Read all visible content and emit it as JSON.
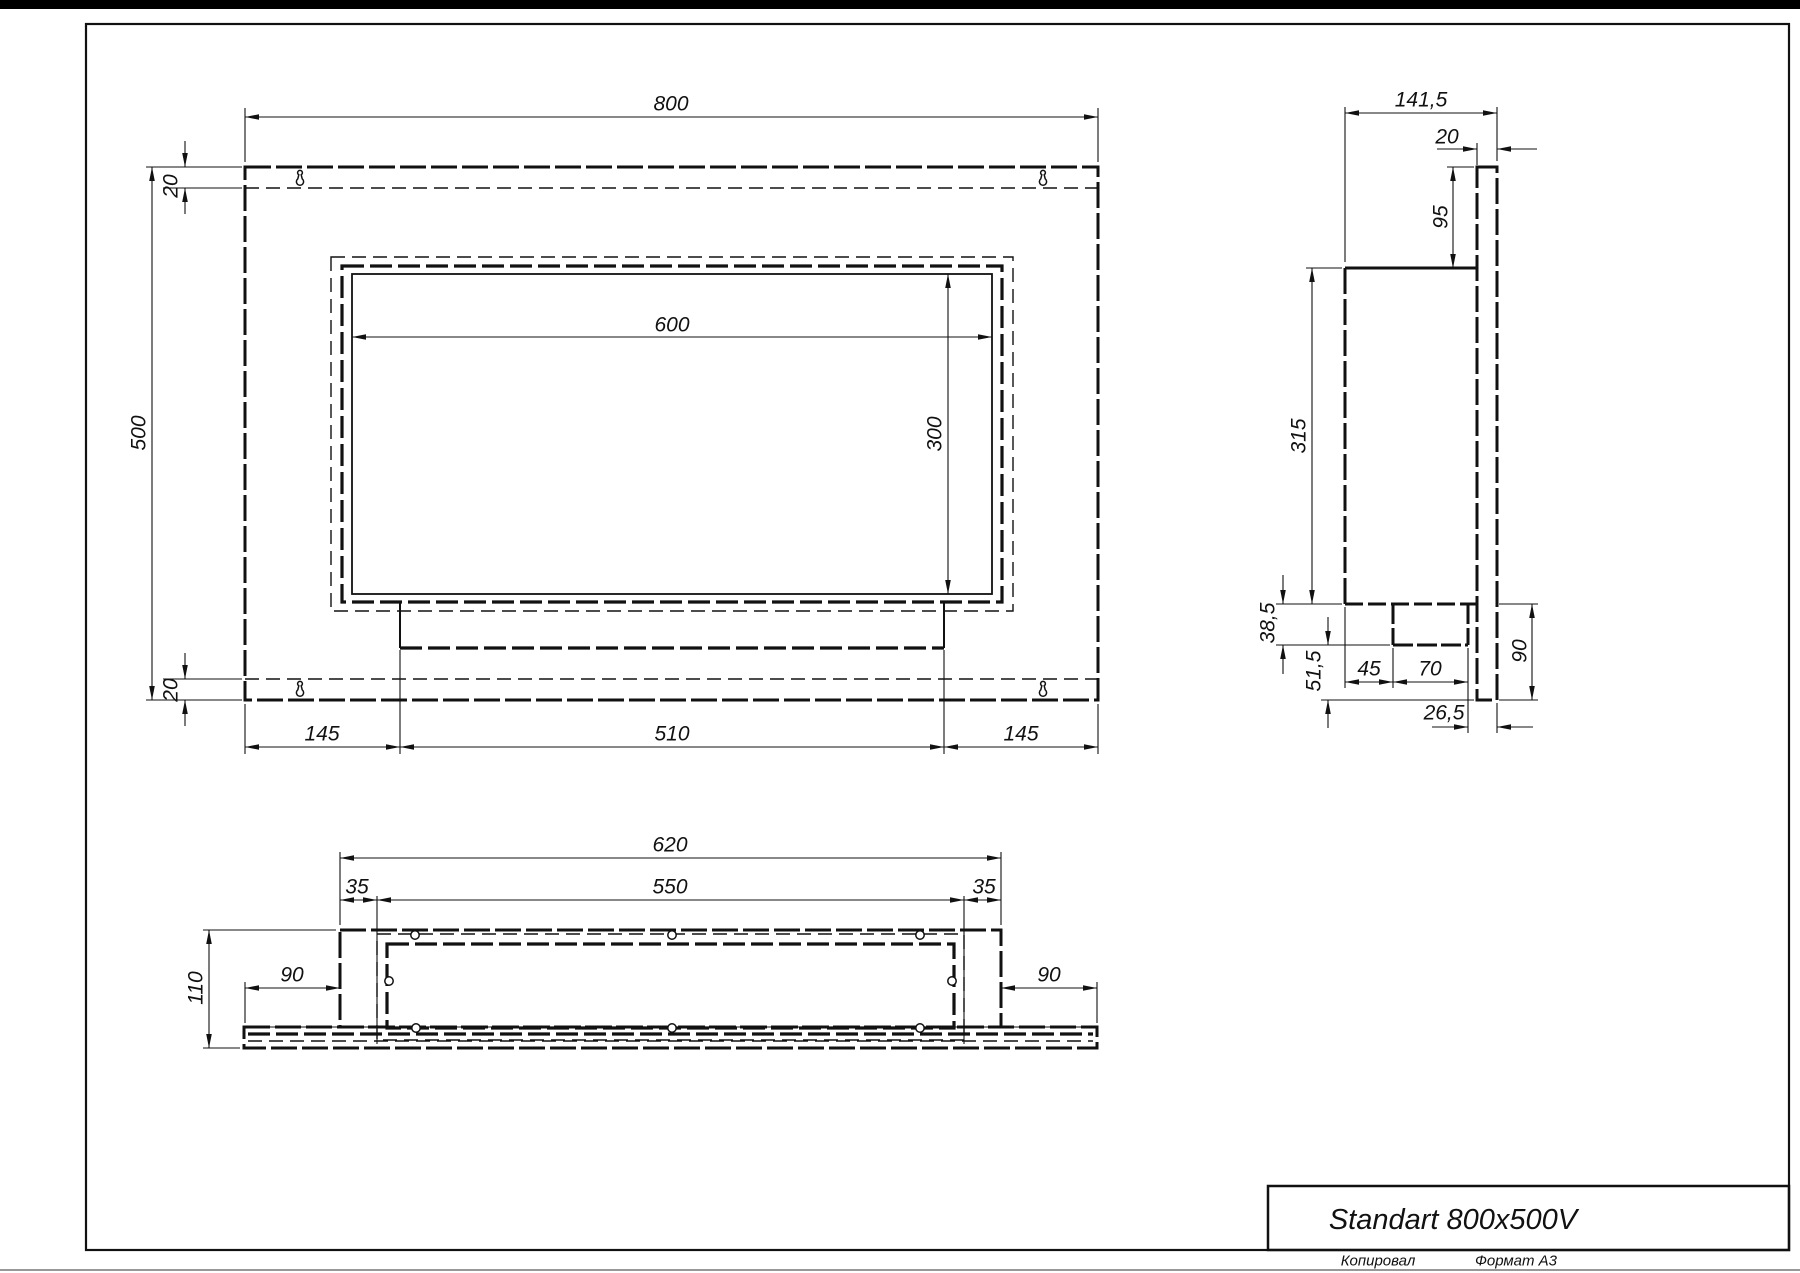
{
  "page": {
    "title_block": {
      "title": "Standart 800x500V"
    },
    "footer": {
      "copied_label": "Копировал",
      "format_label": "Формат А3"
    }
  },
  "style": {
    "line_color": "#111111",
    "paper_color": "#ffffff"
  },
  "views": {
    "front_view": {
      "dim_labels": [
        {
          "text": "800",
          "x": 671,
          "y": 104,
          "rot": 0
        },
        {
          "text": "500",
          "x": 139,
          "y": 433,
          "rot": 1
        },
        {
          "text": "20",
          "x": 171,
          "y": 186,
          "rot": 1
        },
        {
          "text": "20",
          "x": 171,
          "y": 690,
          "rot": 1
        },
        {
          "text": "600",
          "x": 672,
          "y": 325,
          "rot": 0
        },
        {
          "text": "300",
          "x": 935,
          "y": 434,
          "rot": 1
        },
        {
          "text": "145",
          "x": 322,
          "y": 734,
          "rot": 0
        },
        {
          "text": "510",
          "x": 672,
          "y": 734,
          "rot": 0
        },
        {
          "text": "145",
          "x": 1021,
          "y": 734,
          "rot": 0
        }
      ]
    },
    "side_view": {
      "dim_labels": [
        {
          "text": "141,5",
          "x": 1421,
          "y": 100,
          "rot": 0
        },
        {
          "text": "20",
          "x": 1447,
          "y": 137,
          "rot": 0
        },
        {
          "text": "95",
          "x": 1441,
          "y": 217,
          "rot": 1
        },
        {
          "text": "315",
          "x": 1299,
          "y": 436,
          "rot": 1
        },
        {
          "text": "38,5",
          "x": 1268,
          "y": 623,
          "rot": 1
        },
        {
          "text": "51,5",
          "x": 1314,
          "y": 671,
          "rot": 1
        },
        {
          "text": "45",
          "x": 1369,
          "y": 669,
          "rot": 0
        },
        {
          "text": "70",
          "x": 1430,
          "y": 669,
          "rot": 0
        },
        {
          "text": "90",
          "x": 1520,
          "y": 651,
          "rot": 1
        },
        {
          "text": "26,5",
          "x": 1444,
          "y": 713,
          "rot": 0
        }
      ]
    },
    "bottom_view": {
      "dim_labels": [
        {
          "text": "620",
          "x": 670,
          "y": 845,
          "rot": 0
        },
        {
          "text": "550",
          "x": 670,
          "y": 887,
          "rot": 0
        },
        {
          "text": "35",
          "x": 357,
          "y": 887,
          "rot": 0
        },
        {
          "text": "35",
          "x": 984,
          "y": 887,
          "rot": 0
        },
        {
          "text": "110",
          "x": 196,
          "y": 988,
          "rot": 1
        },
        {
          "text": "90",
          "x": 292,
          "y": 975,
          "rot": 0
        },
        {
          "text": "90",
          "x": 1049,
          "y": 975,
          "rot": 0
        }
      ]
    }
  }
}
